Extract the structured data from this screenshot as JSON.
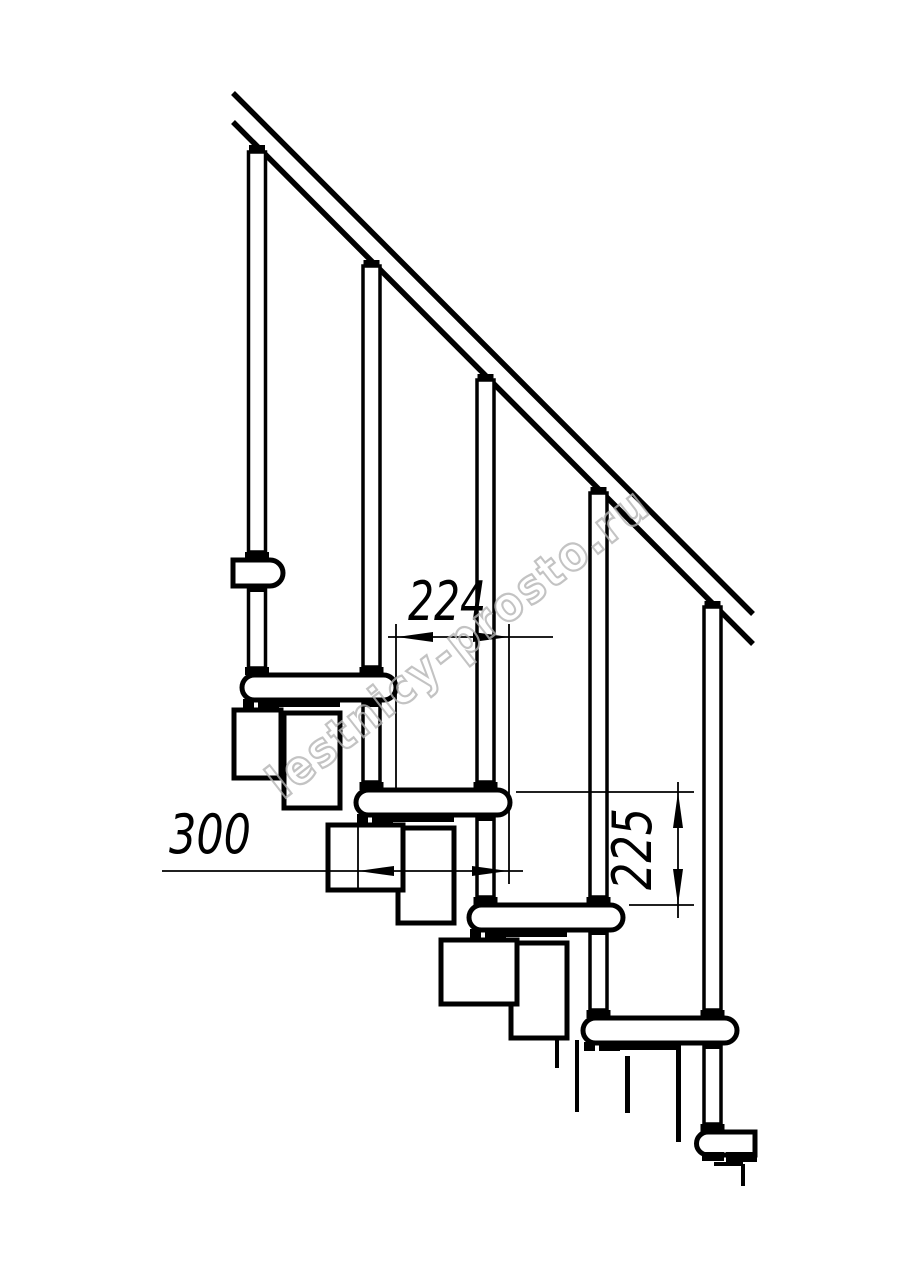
{
  "page": {
    "background": "#ffffff",
    "line_color": "#000000",
    "watermark_color": "#b5b5b5"
  },
  "watermark": {
    "text": "lestnicy-prosto.ru"
  },
  "drawing": {
    "type": "modular-staircase-side-view",
    "dimensions": {
      "step_run": "224",
      "tread_depth": "300",
      "riser_height": "225"
    }
  }
}
